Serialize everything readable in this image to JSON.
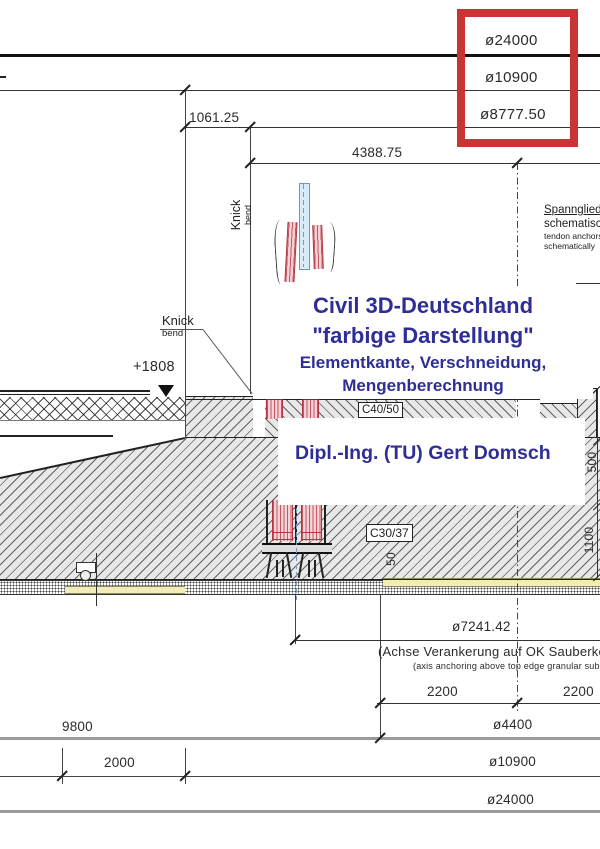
{
  "colors": {
    "highlight_box": "#c93434",
    "watermark_blue": "#2e2e96",
    "concrete_gray": "#e8e8e8",
    "blinding_yellow": "#f1ecba",
    "tendon_pink": "#f3d3d7",
    "duct_blue": "#d9ebf6"
  },
  "top_dimensions": {
    "d24000": "ø24000",
    "d10900": "ø10900",
    "d8777": "ø8777.50",
    "d1061": "1061.25",
    "d4388": "4388.75"
  },
  "labels": {
    "knick_rotated": {
      "de": "Knick",
      "en": "bend"
    },
    "knick_leader": {
      "de": "Knick",
      "en": "bend"
    },
    "elevation": "+1808",
    "tendon_note": {
      "de1": "Spannglieder",
      "de2": "schematisch",
      "en1": "tendon anchors",
      "en2": "schematically"
    },
    "concrete_upper": "C40/50",
    "concrete_lower": "C30/37",
    "dim_50": "50",
    "dim_500": "500",
    "dim_1100": "1100"
  },
  "watermark": {
    "line1": "Civil 3D-Deutschland",
    "line2": "\"farbige Darstellung\"",
    "line3": "Elementkante, Verschneidung,",
    "line4": "Mengenberechnung",
    "author": "Dipl.-Ing. (TU) Gert Domsch"
  },
  "bottom_dimensions": {
    "d7241": "ø7241.42",
    "achse_de": "(Achse Verankerung auf OK Sauberkeitsschicht",
    "achse_en": "(axis anchoring above top edge granular subbase",
    "d2200a": "2200",
    "d2200b": "2200",
    "d9800": "9800",
    "d4400": "ø4400",
    "d2000": "2000",
    "d10900": "ø10900",
    "d24000": "ø24000"
  }
}
